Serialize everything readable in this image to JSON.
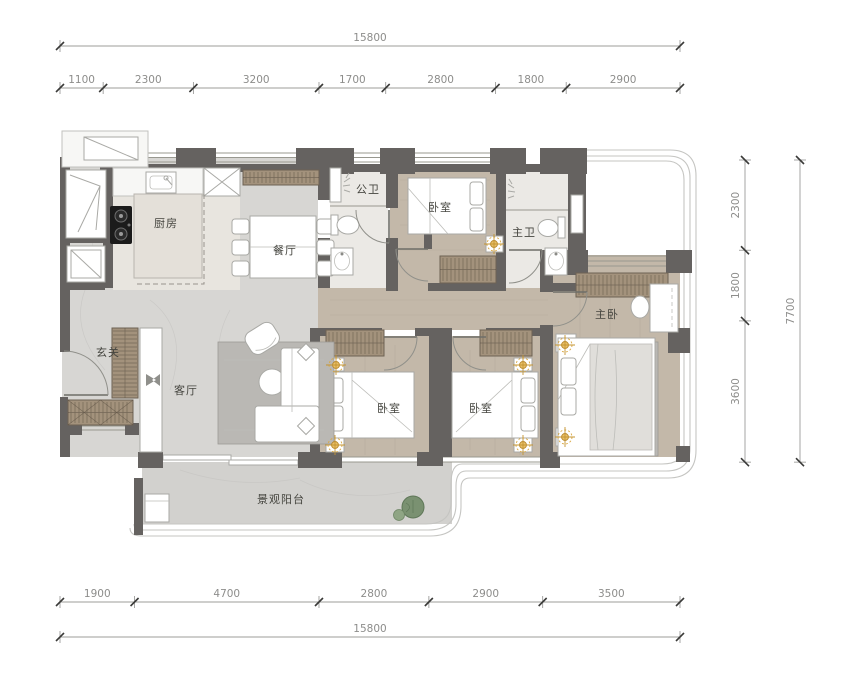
{
  "drawing": {
    "type": "apartment floor plan",
    "unit_system": "mm"
  },
  "dimensions": {
    "top": {
      "total": 15800,
      "segments": [
        1100,
        2300,
        3200,
        1700,
        2800,
        1800,
        2900
      ]
    },
    "bottom": {
      "total": 15800,
      "segments": [
        1900,
        4700,
        2800,
        2900,
        3500
      ]
    },
    "right": {
      "total": 7700,
      "segments": [
        2300,
        1800,
        3600
      ]
    }
  },
  "rooms": [
    {
      "id": "kitchen",
      "label": "厨房"
    },
    {
      "id": "dining",
      "label": "餐厅"
    },
    {
      "id": "public-bath",
      "label": "公卫"
    },
    {
      "id": "bedroom-top",
      "label": "卧室"
    },
    {
      "id": "master-bath",
      "label": "主卫"
    },
    {
      "id": "master-bedroom",
      "label": "主卧"
    },
    {
      "id": "foyer",
      "label": "玄关"
    },
    {
      "id": "living",
      "label": "客厅"
    },
    {
      "id": "bedroom-left",
      "label": "卧室"
    },
    {
      "id": "bedroom-right",
      "label": "卧室"
    },
    {
      "id": "balcony",
      "label": "景观阳台"
    }
  ],
  "colors": {
    "wall": "#656260",
    "wood_floor": "#c3b8a9",
    "marble_floor": "#d7d6d3",
    "balcony_floor": "#d2d1ce",
    "tile_floor": "#ebe9e5",
    "kitchen_floor": "#e8e5df",
    "cabinet_hatch": "#a3927c",
    "hatch_line": "#4d4338",
    "accent_gold": "#d9a843",
    "plant_green": "#7a9171",
    "rug_gray": "#bab8b4",
    "dim_text": "#8d8d8b",
    "dim_line": "#9c9c9a",
    "tick": "#3a3a38",
    "label_text": "#45453f",
    "furniture_stroke": "#a9a9a5",
    "glazing": "#c5c5c2"
  }
}
